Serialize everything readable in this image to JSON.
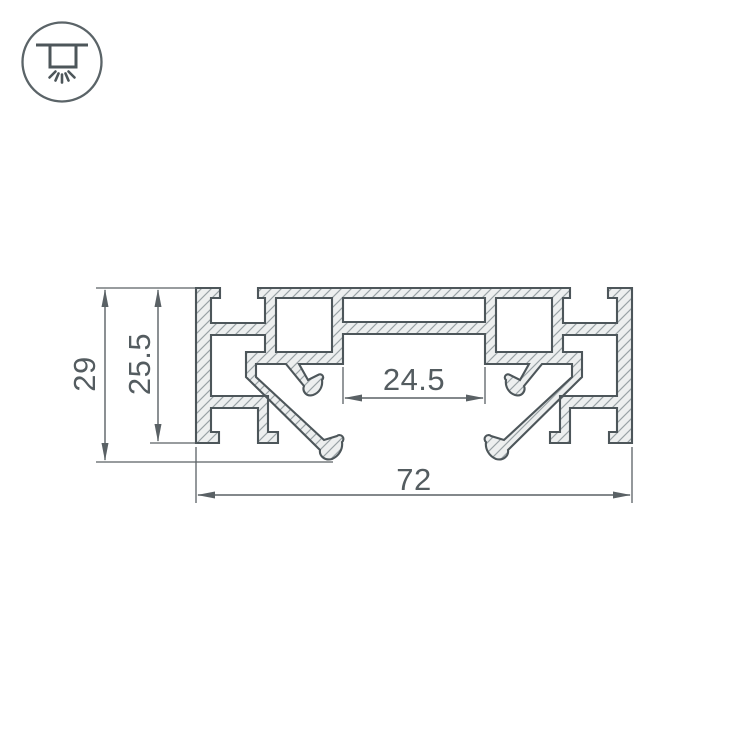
{
  "page": {
    "background_color": "#ffffff"
  },
  "badge": {
    "icon": "ceiling-light-icon"
  },
  "drawing": {
    "type": "technical-cross-section",
    "dimensions": {
      "overall_width": {
        "value": "72"
      },
      "overall_height": {
        "value": "29"
      },
      "body_height": {
        "value": "25.5"
      },
      "channel_width": {
        "value": "24.5"
      }
    },
    "colors": {
      "outline": "#4d565a",
      "material_fill": "#edefef",
      "hatch_line": "#98a1a5",
      "dimension": "#5a6165",
      "text": "#545c60",
      "badge_stroke": "#5b6468"
    }
  }
}
